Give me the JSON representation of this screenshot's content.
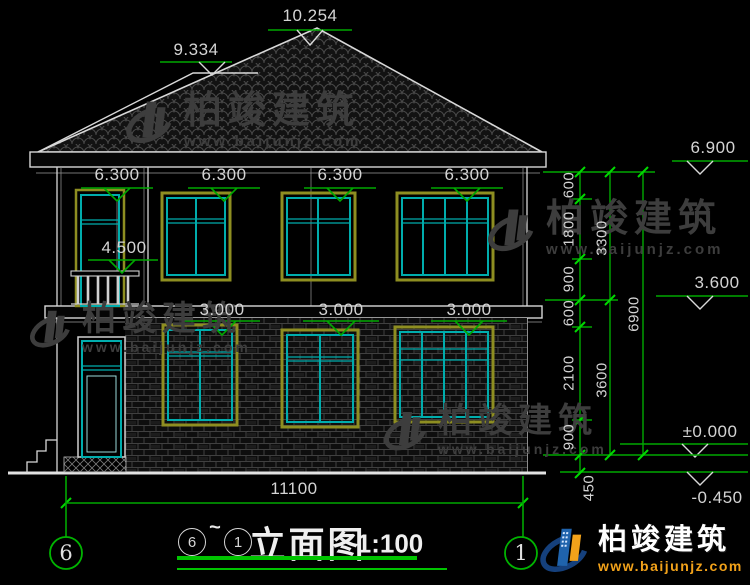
{
  "drawing": {
    "title_ref_start": "6",
    "title_tilde": "~",
    "title_ref_end": "1",
    "title_text": "立面图",
    "title_scale": "1:100"
  },
  "axis_bubbles": {
    "left": "6",
    "right": "1"
  },
  "elevations": {
    "ridge_main": "10.254",
    "ridge_low": "9.334",
    "eave": "6.900",
    "floor2": "3.600",
    "ground_floor": "±0.000",
    "site": "-0.450"
  },
  "facade_labels": {
    "floor2_windows": [
      "6.300",
      "6.300",
      "6.300",
      "6.300"
    ],
    "balcony": "4.500",
    "floor1_windows": [
      "3.000",
      "3.000",
      "3.000"
    ]
  },
  "dims": {
    "total_width": "11100",
    "inner_chain": [
      "600",
      "1800",
      "900",
      "600",
      "2100",
      "900"
    ],
    "plinth": "450",
    "mid_chain": [
      "3300",
      "3600"
    ],
    "outer_chain": "6900"
  },
  "watermark": {
    "brand": "柏竣建筑",
    "url": "www.baijunjz.com"
  },
  "brand_logo": {
    "brand": "柏竣建筑",
    "url": "www.baijunjz.com"
  },
  "colors": {
    "dim_green": "#00a800",
    "tick_green": "#00d800",
    "cad_white": "#d8d8d8",
    "frame_olive": "#8e8e21",
    "frame_cyan": "#00adad",
    "logo_blue": "#1f63ac",
    "logo_orange": "#f2a21a"
  }
}
